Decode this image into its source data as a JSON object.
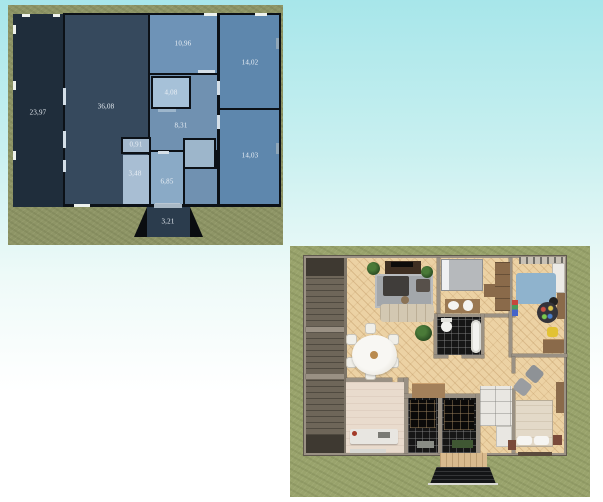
{
  "scene": {
    "sky_top_color": "#a7e6ea",
    "sky_bottom_color": "#ffffff"
  },
  "plan2d": {
    "grass_color": "#8e9566",
    "wall_color": "#0c1117",
    "label_color": "#e9eff5",
    "rooms": {
      "terrace": {
        "area": "23,97",
        "color": "#1f2d3b"
      },
      "living": {
        "area": "36,08",
        "color": "#36495d"
      },
      "bedroom_top": {
        "area": "10,96",
        "color": "#6e93b7"
      },
      "bedroom_right_top": {
        "area": "14,02",
        "color": "#5e87ad"
      },
      "closet": {
        "area": "4,08",
        "color": "#a6c1d8"
      },
      "hall": {
        "area": "8,31",
        "color": "#7091b1"
      },
      "bedroom_right_bottom": {
        "area": "14,03",
        "color": "#5e87ad"
      },
      "wc": {
        "area": "0,91",
        "color": "#a3b9ce"
      },
      "bathroom": {
        "area": "3,48",
        "color": "#a8bed3"
      },
      "hall_lower": {
        "area": "6,85",
        "color": "#8aaac6"
      },
      "porch": {
        "area": "3,21",
        "color": "#2b3c4d"
      }
    }
  },
  "plan3d": {
    "grass_color": "#99a36c",
    "wall_color": "#9a9184",
    "floor_color": "#ecd2a4",
    "terrace_color": "#6e6659",
    "bathroom_tile_color": "#161616",
    "living_rug_color": "#a3a7ab",
    "kids_rug_color": "#8fb3cd"
  }
}
